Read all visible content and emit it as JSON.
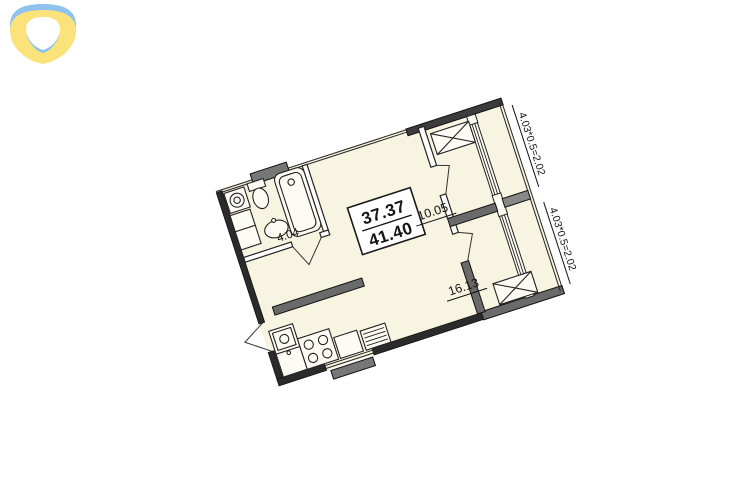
{
  "logo": {
    "name": "brand-mark",
    "color_blue": "#8fc3ee",
    "color_yellow": "#fbe27b"
  },
  "floor_plan": {
    "area_box": {
      "upper": "37.37",
      "lower": "41.40"
    },
    "rooms": {
      "room_a": {
        "area": "10.05"
      },
      "room_b": {
        "area": "16.13"
      },
      "bathroom": {
        "area": "4.04"
      }
    },
    "loggias": [
      {
        "dimension": "4.03*0.5=2.02"
      },
      {
        "dimension": "4.03*0.5=2.02"
      }
    ],
    "colors": {
      "floor": "#f8f4e2",
      "wall_dark": "#2b2b2b",
      "wall_gray": "#6a6a6a",
      "line": "#222222"
    }
  }
}
